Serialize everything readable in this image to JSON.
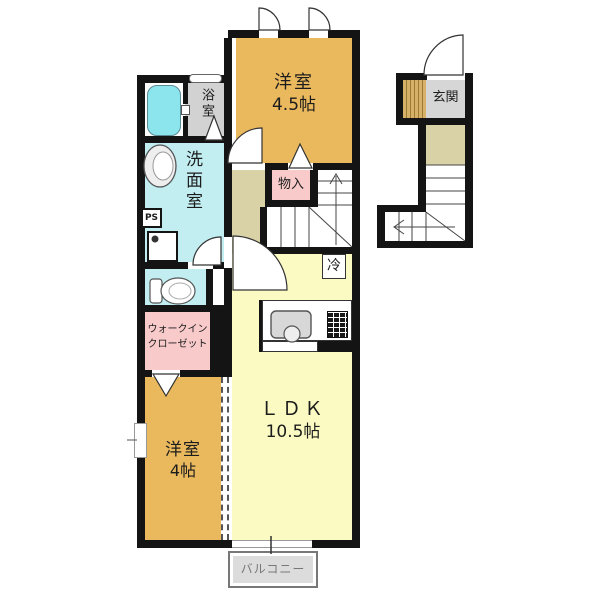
{
  "plan_title": "apartment-floor-plan",
  "rooms": {
    "bedroom45": {
      "name": "洋室",
      "size": "4.5帖"
    },
    "bedroom4": {
      "name": "洋室",
      "size": "4帖"
    },
    "ldk": {
      "name": "ＬＤＫ",
      "size": "10.5帖"
    },
    "bathroom": {
      "name": "浴室"
    },
    "washroom": {
      "name": "洗面室"
    },
    "wic": {
      "line1": "ウォークイン",
      "line2": "クローゼット"
    },
    "storage": {
      "name": "物入"
    },
    "entrance": {
      "name": "玄関"
    },
    "balcony": {
      "name": "バルコニー"
    },
    "fridge": {
      "name": "冷"
    },
    "pipe_space": {
      "name": "PS"
    }
  },
  "colors": {
    "wall": "#141414",
    "bedroom": "#eab95e",
    "ldk": "#fafac2",
    "wet_area": "#c2eef2",
    "bathtub": "#8ce4ec",
    "closet": "#f8caca",
    "hallway": "#d8d2a6",
    "entrance_floor": "#d6d6d6",
    "balcony": "#dcdcdc"
  }
}
